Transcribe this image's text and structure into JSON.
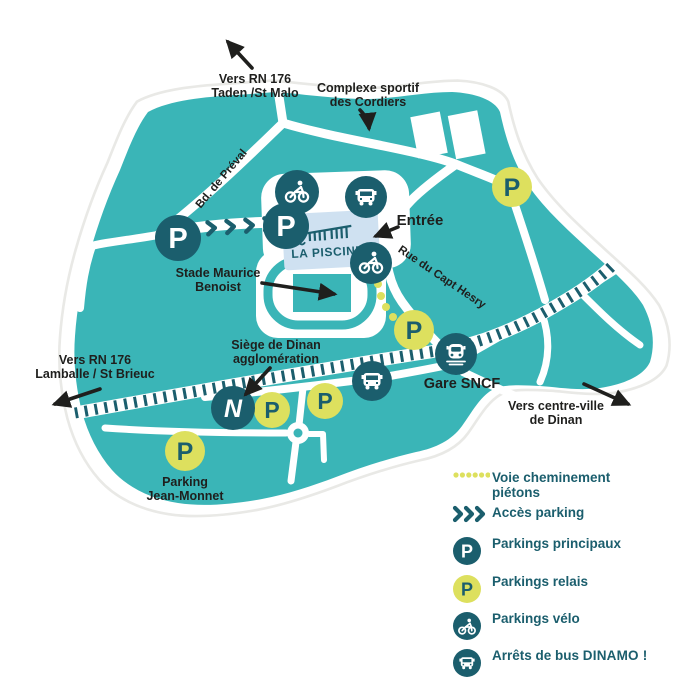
{
  "map": {
    "destinations": {
      "taden": {
        "line1": "Vers RN 176",
        "line2": "Taden /St Malo"
      },
      "lamballe": {
        "line1": "Vers RN 176",
        "line2": "Lamballe / St Brieuc"
      },
      "centre_ville": {
        "line1": "Vers centre-ville",
        "line2": "de Dinan"
      }
    },
    "roads": {
      "bd_preval": "Bd. de Préval",
      "rue_capt_hesry": "Rue du Capt Hesry"
    },
    "places": {
      "complexe_sportif": {
        "line1": "Complexe sportif",
        "line2": "des Cordiers"
      },
      "stade": {
        "line1": "Stade Maurice",
        "line2": "Benoist"
      },
      "siege": {
        "line1": "Siège de Dinan",
        "line2": "agglomération"
      },
      "parking_jm": {
        "line1": "Parking",
        "line2": "Jean-Monnet"
      },
      "gare": "Gare SNCF",
      "entree": "Entrée",
      "la_piscine": "LA PISCINE"
    },
    "marker_letter": "P",
    "agglo_logo_letter": "N"
  },
  "legend": {
    "items": [
      {
        "line1": "Voie cheminement",
        "line2": "piétons"
      },
      {
        "label": "Accès parking"
      },
      {
        "label": "Parkings principaux"
      },
      {
        "label": "Parkings relais"
      },
      {
        "label": "Parkings vélo"
      },
      {
        "label": "Arrêts de bus",
        "brand": "DINAMO !"
      }
    ]
  },
  "colors": {
    "teal": "#3ab5b7",
    "dark_teal": "#1b5e6d",
    "yellow": "#dde05e",
    "pool_blue": "#cfe1f1",
    "label_dark": "#1f1f1d"
  }
}
